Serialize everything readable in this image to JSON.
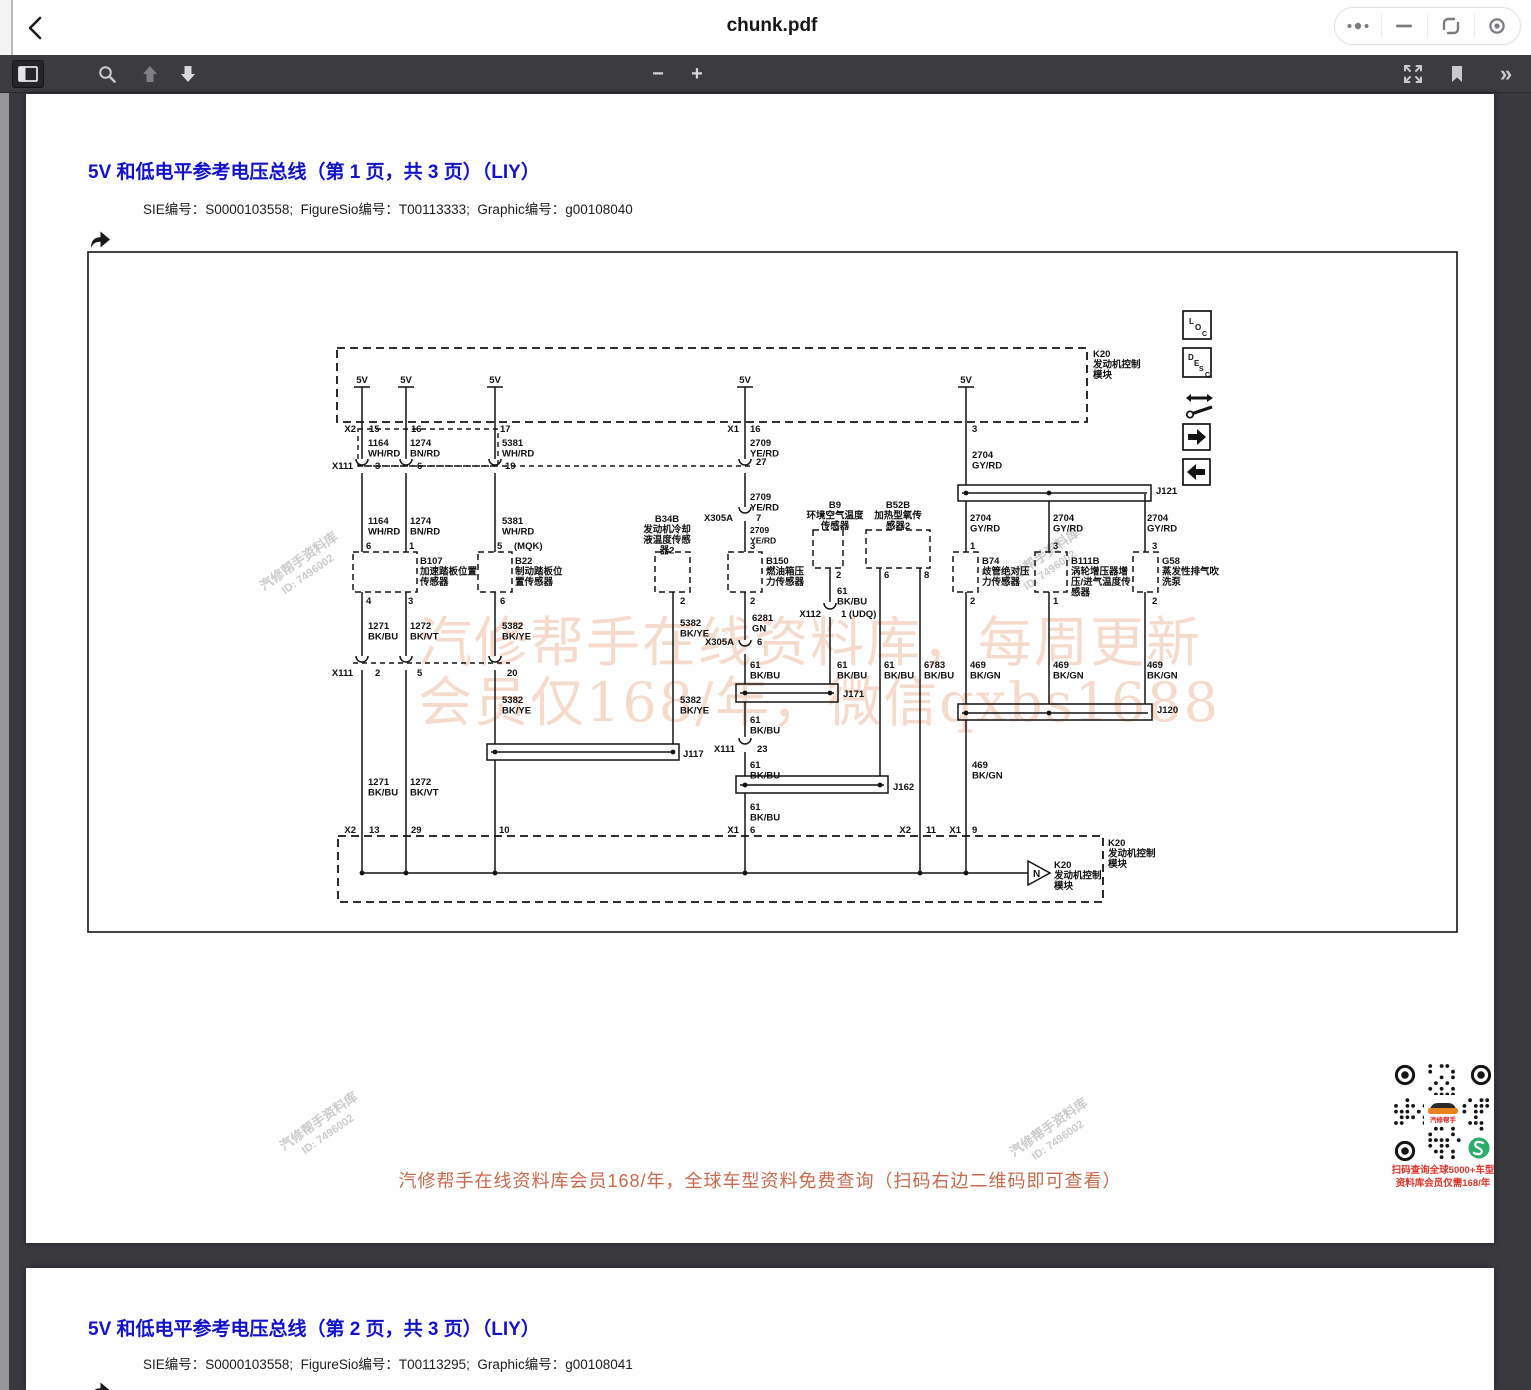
{
  "titlebar": {
    "title": "chunk.pdf"
  },
  "toolbar": {
    "page_value": "1",
    "page_total": "/ 13",
    "zoom_value": "自动缩放",
    "minus": "−",
    "plus": "+",
    "chevrons": "»"
  },
  "page1": {
    "heading": "5V 和低电平参考电压总线（第 1 页，共 3 页）（LIY）",
    "meta": "SIE编号：S0000103558;  FigureSio编号：T00113333;  Graphic编号：g00108040"
  },
  "page2": {
    "heading": "5V 和低电平参考电压总线（第 2 页，共 3 页）（LIY）",
    "meta": "SIE编号：S0000103558;  FigureSio编号：T00113295;  Graphic编号：g00108041"
  },
  "promo": {
    "banner": "汽修帮手在线资料库会员168/年，全球车型资料免费查询（扫码右边二维码即可查看）",
    "qr_caption1": "扫码查询全球5000+车型",
    "qr_caption2": "资料库会员仅需168/年",
    "qr_logo_text": "汽修帮手",
    "banner_color": "#c9694d",
    "caption_color": "#e03328",
    "logo_orange": "#e8821e",
    "green_logo_color": "#2aae67"
  },
  "watermark": {
    "big1": "汽修帮手在线资料库，每周更新",
    "big2": "会员仅168/年，微信qxbs1688",
    "diag_line1": "汽修帮手资料库",
    "diag_line2": "ID: 7496002"
  },
  "diagram": {
    "labels": [
      {
        "x": 362,
        "y": 383,
        "t": "5V",
        "a": "m"
      },
      {
        "x": 406,
        "y": 383,
        "t": "5V",
        "a": "m"
      },
      {
        "x": 495,
        "y": 383,
        "t": "5V",
        "a": "m"
      },
      {
        "x": 745,
        "y": 383,
        "t": "5V",
        "a": "m"
      },
      {
        "x": 966,
        "y": 383,
        "t": "5V",
        "a": "m"
      },
      {
        "x": 1093,
        "y": 357,
        "t": "K20\n发动机控制\n模块"
      },
      {
        "x": 356,
        "y": 432,
        "t": "X2",
        "a": "e"
      },
      {
        "x": 369,
        "y": 432,
        "t": "15"
      },
      {
        "x": 411,
        "y": 432,
        "t": "16"
      },
      {
        "x": 500,
        "y": 432,
        "t": "17"
      },
      {
        "x": 739,
        "y": 432,
        "t": "X1",
        "a": "e"
      },
      {
        "x": 750,
        "y": 432,
        "t": "16"
      },
      {
        "x": 972,
        "y": 432,
        "t": "3"
      },
      {
        "x": 368,
        "y": 446,
        "t": "1164\nWH/RD"
      },
      {
        "x": 410,
        "y": 446,
        "t": "1274\nBN/RD"
      },
      {
        "x": 502,
        "y": 446,
        "t": "5381\nWH/RD"
      },
      {
        "x": 750,
        "y": 446,
        "t": "2709\nYE/RD"
      },
      {
        "x": 972,
        "y": 458,
        "t": "2704\nGY/RD"
      },
      {
        "x": 353,
        "y": 469,
        "t": "X111",
        "a": "e"
      },
      {
        "x": 375,
        "y": 469,
        "t": "3"
      },
      {
        "x": 417,
        "y": 469,
        "t": "6"
      },
      {
        "x": 505,
        "y": 469,
        "t": "19"
      },
      {
        "x": 756,
        "y": 465,
        "t": "27"
      },
      {
        "x": 368,
        "y": 524,
        "t": "1164\nWH/RD"
      },
      {
        "x": 410,
        "y": 524,
        "t": "1274\nBN/RD"
      },
      {
        "x": 502,
        "y": 524,
        "t": "5381\nWH/RD"
      },
      {
        "x": 750,
        "y": 500,
        "t": "2709\nYE/RD"
      },
      {
        "x": 733,
        "y": 521,
        "t": "X305A",
        "a": "e"
      },
      {
        "x": 756,
        "y": 521,
        "t": "7"
      },
      {
        "x": 750,
        "y": 533,
        "t": "2709\nYE/RD",
        "s": 8.6
      },
      {
        "x": 750,
        "y": 549,
        "t": "3"
      },
      {
        "x": 366,
        "y": 549,
        "t": "6"
      },
      {
        "x": 409,
        "y": 549,
        "t": "1"
      },
      {
        "x": 497,
        "y": 549,
        "t": "5"
      },
      {
        "x": 514,
        "y": 549,
        "t": "(MQK)"
      },
      {
        "x": 970,
        "y": 549,
        "t": "1"
      },
      {
        "x": 1053,
        "y": 549,
        "t": "3"
      },
      {
        "x": 1152,
        "y": 549,
        "t": "3"
      },
      {
        "x": 420,
        "y": 564,
        "t": "B107\n加速踏板位置\n传感器"
      },
      {
        "x": 515,
        "y": 564,
        "t": "B22\n制动踏板位\n置传感器"
      },
      {
        "x": 667,
        "y": 522,
        "t": "B34B\n发动机冷却\n液温度传感\n器2",
        "a": "m"
      },
      {
        "x": 766,
        "y": 564,
        "t": "B150\n燃油箱压\n力传感器"
      },
      {
        "x": 835,
        "y": 508,
        "t": "B9\n环境空气温度\n传感器",
        "a": "m"
      },
      {
        "x": 898,
        "y": 508,
        "t": "B52B\n加热型氧传\n感器2",
        "a": "m"
      },
      {
        "x": 982,
        "y": 564,
        "t": "B74\n歧管绝对压\n力传感器"
      },
      {
        "x": 1071,
        "y": 564,
        "t": "B111B\n涡轮增压器增\n压/进气温度传\n感器"
      },
      {
        "x": 1162,
        "y": 564,
        "t": "G58\n蒸发性排气吹\n洗泵"
      },
      {
        "x": 366,
        "y": 604,
        "t": "4"
      },
      {
        "x": 408,
        "y": 604,
        "t": "3"
      },
      {
        "x": 500,
        "y": 604,
        "t": "6"
      },
      {
        "x": 680,
        "y": 604,
        "t": "2"
      },
      {
        "x": 750,
        "y": 604,
        "t": "2"
      },
      {
        "x": 836,
        "y": 578,
        "t": "2"
      },
      {
        "x": 884,
        "y": 578,
        "t": "6"
      },
      {
        "x": 924,
        "y": 578,
        "t": "8"
      },
      {
        "x": 970,
        "y": 604,
        "t": "2"
      },
      {
        "x": 1053,
        "y": 604,
        "t": "1"
      },
      {
        "x": 1152,
        "y": 604,
        "t": "2"
      },
      {
        "x": 970,
        "y": 521,
        "t": "2704\nGY/RD"
      },
      {
        "x": 1053,
        "y": 521,
        "t": "2704\nGY/RD"
      },
      {
        "x": 1147,
        "y": 521,
        "t": "2704\nGY/RD"
      },
      {
        "x": 368,
        "y": 629,
        "t": "1271\nBK/BU"
      },
      {
        "x": 410,
        "y": 629,
        "t": "1272\nBK/VT"
      },
      {
        "x": 502,
        "y": 629,
        "t": "5382\nBK/YE"
      },
      {
        "x": 680,
        "y": 626,
        "t": "5382\nBK/YE"
      },
      {
        "x": 752,
        "y": 621,
        "t": "6281\nGN"
      },
      {
        "x": 837,
        "y": 594,
        "t": "61\nBK/BU"
      },
      {
        "x": 734,
        "y": 645,
        "t": "X305A",
        "a": "e"
      },
      {
        "x": 757,
        "y": 645,
        "t": "6"
      },
      {
        "x": 821,
        "y": 617,
        "t": "X112",
        "a": "e"
      },
      {
        "x": 841,
        "y": 617,
        "t": "1 (UDQ)"
      },
      {
        "x": 750,
        "y": 668,
        "t": "61\nBK/BU"
      },
      {
        "x": 837,
        "y": 668,
        "t": "61\nBK/BU"
      },
      {
        "x": 884,
        "y": 668,
        "t": "61\nBK/BU"
      },
      {
        "x": 924,
        "y": 668,
        "t": "6783\nBK/BU"
      },
      {
        "x": 970,
        "y": 668,
        "t": "469\nBK/GN"
      },
      {
        "x": 1053,
        "y": 668,
        "t": "469\nBK/GN"
      },
      {
        "x": 1147,
        "y": 668,
        "t": "469\nBK/GN"
      },
      {
        "x": 353,
        "y": 676,
        "t": "X111",
        "a": "e"
      },
      {
        "x": 375,
        "y": 676,
        "t": "2"
      },
      {
        "x": 417,
        "y": 676,
        "t": "5"
      },
      {
        "x": 507,
        "y": 676,
        "t": "20"
      },
      {
        "x": 1156,
        "y": 494,
        "t": "J121"
      },
      {
        "x": 843,
        "y": 697,
        "t": "J171"
      },
      {
        "x": 683,
        "y": 757,
        "t": "J117"
      },
      {
        "x": 893,
        "y": 790,
        "t": "J162"
      },
      {
        "x": 1157,
        "y": 713,
        "t": "J120"
      },
      {
        "x": 502,
        "y": 703,
        "t": "5382\nBK/YE"
      },
      {
        "x": 680,
        "y": 703,
        "t": "5382\nBK/YE"
      },
      {
        "x": 750,
        "y": 723,
        "t": "61\nBK/BU"
      },
      {
        "x": 735,
        "y": 752,
        "t": "X111",
        "a": "e"
      },
      {
        "x": 757,
        "y": 752,
        "t": "23"
      },
      {
        "x": 750,
        "y": 768,
        "t": "61\nBK/BU"
      },
      {
        "x": 750,
        "y": 810,
        "t": "61\nBK/BU"
      },
      {
        "x": 972,
        "y": 768,
        "t": "469\nBK/GN"
      },
      {
        "x": 368,
        "y": 785,
        "t": "1271\nBK/BU"
      },
      {
        "x": 410,
        "y": 785,
        "t": "1272\nBK/VT"
      },
      {
        "x": 356,
        "y": 833,
        "t": "X2",
        "a": "e"
      },
      {
        "x": 369,
        "y": 833,
        "t": "13"
      },
      {
        "x": 411,
        "y": 833,
        "t": "29"
      },
      {
        "x": 499,
        "y": 833,
        "t": "10"
      },
      {
        "x": 739,
        "y": 833,
        "t": "X1",
        "a": "e"
      },
      {
        "x": 750,
        "y": 833,
        "t": "6"
      },
      {
        "x": 911,
        "y": 833,
        "t": "X2",
        "a": "e"
      },
      {
        "x": 926,
        "y": 833,
        "t": "11"
      },
      {
        "x": 961,
        "y": 833,
        "t": "X1",
        "a": "e"
      },
      {
        "x": 972,
        "y": 833,
        "t": "9"
      },
      {
        "x": 1108,
        "y": 846,
        "t": "K20\n发动机控制\n模块"
      },
      {
        "x": 1054,
        "y": 868,
        "t": "K20\n发动机控制\n模块"
      },
      {
        "x": 1033,
        "y": 877,
        "t": "N",
        "s": 10
      },
      {
        "x": 1189,
        "y": 324,
        "t": "L",
        "s": 8
      },
      {
        "x": 1195,
        "y": 330,
        "t": "O",
        "s": 8
      },
      {
        "x": 1202,
        "y": 336,
        "t": "C",
        "s": 7
      },
      {
        "x": 1188,
        "y": 360,
        "t": "D",
        "s": 8
      },
      {
        "x": 1194,
        "y": 366,
        "t": "E",
        "s": 8
      },
      {
        "x": 1199,
        "y": 371,
        "t": "S",
        "s": 7
      },
      {
        "x": 1205,
        "y": 377,
        "t": "C",
        "s": 7
      }
    ]
  }
}
